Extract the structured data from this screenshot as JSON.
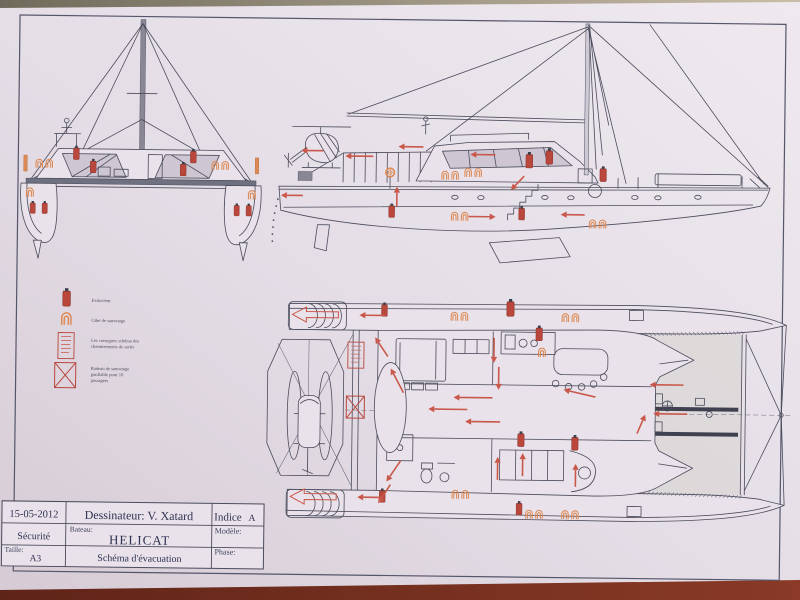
{
  "photo": {
    "table_top_color": "#6f6a5b",
    "table_bottom_color": "#6e2b1e",
    "paper_color": "#e6dfe7"
  },
  "drawing": {
    "ink_color": "#4b4c5c",
    "safety_red": "#b9473c",
    "arrow_red": "#c9584b",
    "lifejacket_orange": "#dd8a55",
    "views": [
      "front-view",
      "side-view",
      "deck-plan-view"
    ]
  },
  "legend": {
    "items": [
      {
        "icon": "fire-extinguisher-icon",
        "label": "Extincteur",
        "lines": [
          "Extincteur"
        ]
      },
      {
        "icon": "life-jacket-icon",
        "label": "Gilet de sauvetage",
        "lines": [
          "Gilet de sauvetage"
        ]
      },
      {
        "icon": "safety-instructions-sign-icon",
        "label": "Les consignes schéma des cheminements de sortie",
        "lines": [
          "Les consignes schéma des",
          "cheminements de sortie"
        ]
      },
      {
        "icon": "life-raft-icon",
        "label": "Radeau de sauvetage gonflable pour 10 passagers",
        "lines": [
          "Radeau de sauvetage",
          "gonflable pour 10",
          "passagers"
        ]
      }
    ]
  },
  "title_block": {
    "date": "15-05-2012",
    "designer": "Dessinateur: V. Xatard",
    "index_label": "Indice",
    "index_value": "A",
    "department": "Sécurité",
    "boat_label": "Bateau:",
    "boat_name": "HELICAT",
    "model_label": "Modèle:",
    "size_label": "Taille:",
    "size_value": "A3",
    "drawing_title": "Schéma d'évacuation",
    "phase_label": "Phase:"
  }
}
